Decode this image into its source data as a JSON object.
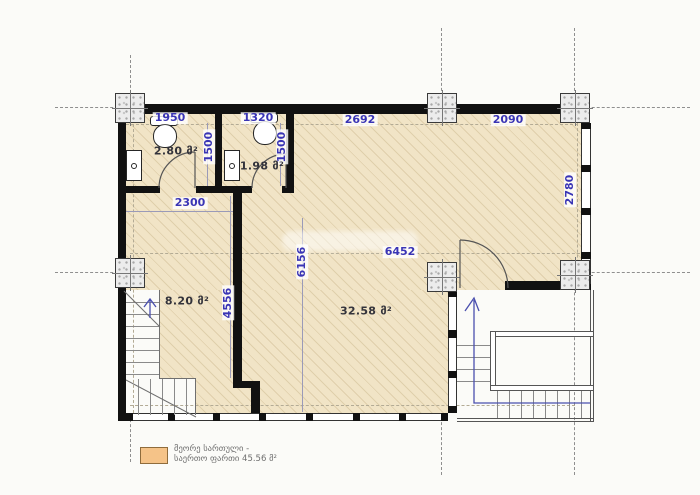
{
  "plan_type": "architectural-floor-plan",
  "dimensions": {
    "wc1_width": "1950",
    "wc2_width": "1320",
    "top_span_left": "2692",
    "top_span_right": "2090",
    "wc1_depth": "1500",
    "wc2_depth": "1500",
    "hall_width": "2300",
    "east_bay_height": "2780",
    "main_width": "6452",
    "main_depth": "6156",
    "hall_depth": "4556"
  },
  "rooms": {
    "wc1_area": "2.80 მ²",
    "wc2_area": "1.98 მ²",
    "hall_area": "8.20 მ²",
    "main_area": "32.58 მ²"
  },
  "legend": {
    "line1": "მეორე სართული -",
    "line2": "საერთო ფართი 45.56 მ²"
  },
  "colors": {
    "floor_fill": "#f1e4c6",
    "wall": "#111111",
    "dimension_text": "#3a35b5",
    "legend_swatch": "#f5c388",
    "grid_line": "#8f8f8f"
  }
}
